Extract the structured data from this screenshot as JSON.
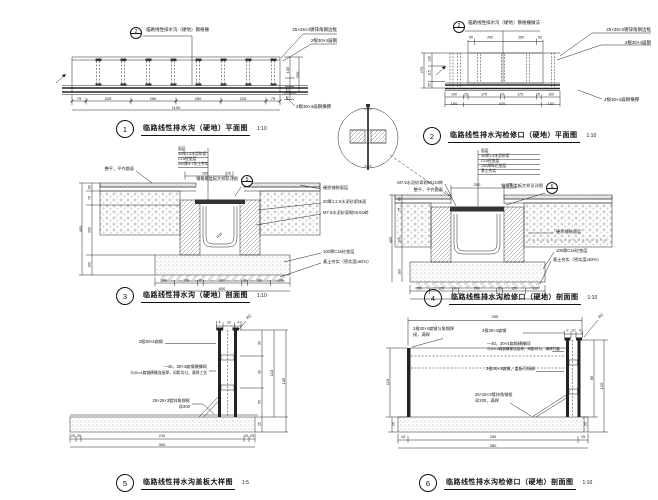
{
  "page": {
    "width": 658,
    "height": 500,
    "background": "#ffffff",
    "line_color": "#222222",
    "text_color": "#151515"
  },
  "details": [
    {
      "id": "detail-1",
      "number": "1",
      "title": "临路线性排水沟（硬地）平面图",
      "scale": "1:10",
      "labels": [
        {
          "x": 146,
          "y": 30,
          "a": "l",
          "s": 4.5,
          "tx": "临路线性排水沟（硬地）钢格栅",
          "n": "annotation"
        },
        {
          "bubble": true,
          "x": 136,
          "y": 33,
          "r": 6,
          "split": true,
          "num": "2"
        },
        {
          "x": 337,
          "y": 30,
          "a": "r",
          "s": 4.5,
          "tx": "25×25×3镀锌角钢边框",
          "n": "annotation"
        },
        {
          "x": 337,
          "y": 41,
          "a": "r",
          "s": 4.5,
          "tx": "2根30×4扁钢",
          "n": "annotation"
        },
        {
          "x": 288,
          "y": 70,
          "s": 4,
          "rot": -90,
          "tx": "105"
        },
        {
          "x": 297.5,
          "y": 75,
          "s": 4,
          "rot": -90,
          "tx": "250"
        },
        {
          "x": 288,
          "y": 90,
          "s": 3.5,
          "rot": -90,
          "tx": "25"
        },
        {
          "x": 288,
          "y": 98,
          "s": 3.5,
          "rot": -90,
          "tx": "75"
        },
        {
          "x": 79,
          "y": 99,
          "s": 4,
          "tx": "75"
        },
        {
          "x": 108,
          "y": 99,
          "s": 4,
          "tx": "225"
        },
        {
          "x": 153,
          "y": 99,
          "s": 4,
          "tx": "250"
        },
        {
          "x": 198,
          "y": 99,
          "s": 4,
          "tx": "250"
        },
        {
          "x": 243,
          "y": 99,
          "s": 4,
          "tx": "225"
        },
        {
          "x": 273,
          "y": 99,
          "s": 4,
          "tx": "75"
        },
        {
          "x": 176,
          "y": 108,
          "s": 4,
          "tx": "1100"
        },
        {
          "x": 296,
          "y": 107,
          "a": "l",
          "s": 4.5,
          "tx": "4根30×4扁钢横撑",
          "n": "annotation"
        }
      ]
    },
    {
      "id": "detail-2",
      "number": "2",
      "title": "临路线性排水沟检修口（硬地）平面图",
      "scale": "1:10",
      "labels": [
        {
          "bubble": true,
          "x": 459,
          "y": 27,
          "r": 6,
          "split": true,
          "num": "2"
        },
        {
          "x": 468,
          "y": 23,
          "a": "l",
          "s": 4.5,
          "tx": "临路线性排水沟（硬地）钢格栅做法",
          "n": "annotation"
        },
        {
          "x": 651,
          "y": 30,
          "a": "r",
          "s": 4.5,
          "tx": "25×25×3镀锌角钢边框",
          "n": "annotation"
        },
        {
          "x": 651,
          "y": 43,
          "a": "r",
          "s": 4.5,
          "tx": "2根30×4扁钢",
          "n": "annotation"
        },
        {
          "x": 471,
          "y": 38,
          "s": 3.5,
          "tx": "50"
        },
        {
          "x": 490,
          "y": 38,
          "s": 3.5,
          "tx": "250"
        },
        {
          "x": 521,
          "y": 38,
          "s": 3.5,
          "tx": "250"
        },
        {
          "x": 540,
          "y": 38,
          "s": 3.5,
          "tx": "50"
        },
        {
          "x": 430,
          "y": 59,
          "s": 3.5,
          "rot": -90,
          "tx": "130"
        },
        {
          "x": 430,
          "y": 73,
          "s": 3.5,
          "rot": -90,
          "tx": "115"
        },
        {
          "x": 430,
          "y": 85,
          "s": 3.5,
          "rot": -90,
          "tx": "25"
        },
        {
          "x": 422,
          "y": 70,
          "s": 4,
          "rot": -90,
          "tx": "270"
        },
        {
          "x": 454,
          "y": 95,
          "s": 3.5,
          "tx": "100"
        },
        {
          "x": 466,
          "y": 95,
          "s": 3.5,
          "tx": "25"
        },
        {
          "x": 484,
          "y": 95,
          "s": 3.5,
          "tx": "175"
        },
        {
          "x": 502,
          "y": 95,
          "s": 3.5,
          "tx": "20"
        },
        {
          "x": 520,
          "y": 95,
          "s": 3.5,
          "tx": "175"
        },
        {
          "x": 538,
          "y": 95,
          "s": 3.5,
          "tx": "25"
        },
        {
          "x": 551,
          "y": 95,
          "s": 3.5,
          "tx": "100"
        },
        {
          "x": 454,
          "y": 103.5,
          "s": 4,
          "tx": "100"
        },
        {
          "x": 502,
          "y": 103.5,
          "s": 4,
          "tx": "420"
        },
        {
          "x": 551,
          "y": 103.5,
          "s": 4,
          "tx": "100"
        },
        {
          "x": 604,
          "y": 100,
          "a": "l",
          "s": 4.5,
          "tx": "4根30×4扁钢横撑",
          "n": "annotation"
        }
      ]
    },
    {
      "id": "detail-3",
      "number": "3",
      "title": "临路线性排水沟（硬地）剖面图",
      "scale": "1:10",
      "labels": [
        {
          "x": 178,
          "y": 150,
          "a": "l",
          "s": 3.8,
          "tx": "面层",
          "n": "annotation"
        },
        {
          "x": 178,
          "y": 155,
          "a": "l",
          "s": 3.8,
          "tx": "30厚1:3水泥砂浆",
          "n": "annotation"
        },
        {
          "x": 178,
          "y": 160,
          "a": "l",
          "s": 3.8,
          "tx": "C15砼垫层",
          "n": "annotation"
        },
        {
          "x": 178,
          "y": 165,
          "a": "l",
          "s": 3.8,
          "tx": "300厚3:7灰土夯实",
          "n": "annotation"
        },
        {
          "x": 205,
          "y": 174,
          "s": 3.5,
          "tx": "265"
        },
        {
          "x": 229,
          "y": 174,
          "s": 3.5,
          "tx": "25"
        },
        {
          "x": 134,
          "y": 169,
          "a": "r",
          "s": 4.2,
          "tx": "整平，平齐路面",
          "n": "annotation"
        },
        {
          "x": 238,
          "y": 179,
          "a": "r",
          "s": 4.2,
          "tx": "钢格栅盖板大样见详图",
          "n": "callout-text"
        },
        {
          "bubble": true,
          "x": 247,
          "y": 181,
          "r": 6,
          "split": true,
          "num": "5"
        },
        {
          "x": 323,
          "y": 188,
          "a": "l",
          "s": 4.2,
          "tx": "硬质铺装面层",
          "n": "annotation"
        },
        {
          "x": 323,
          "y": 202,
          "a": "l",
          "s": 4.2,
          "tx": "20厚1:2.5水泥砂浆抹面",
          "n": "annotation"
        },
        {
          "x": 323,
          "y": 213,
          "a": "l",
          "s": 4.2,
          "tx": "M7.5水泥砂浆砌MU10砖",
          "n": "annotation"
        },
        {
          "x": 323,
          "y": 252,
          "a": "l",
          "s": 4.2,
          "tx": "100厚C15砼垫层",
          "n": "annotation"
        },
        {
          "x": 323,
          "y": 262,
          "a": "l",
          "s": 4.2,
          "tx": "素土夯实（密实度≥92%）",
          "n": "annotation"
        },
        {
          "x": 220,
          "y": 236,
          "s": 3.5,
          "rot": -45,
          "tx": "R30"
        },
        {
          "x": 90,
          "y": 187,
          "s": 3.5,
          "rot": -90,
          "tx": "80"
        },
        {
          "x": 90,
          "y": 198,
          "s": 3.5,
          "rot": -90,
          "tx": "75"
        },
        {
          "x": 90,
          "y": 230,
          "s": 3.5,
          "rot": -90,
          "tx": "200"
        },
        {
          "x": 90,
          "y": 265,
          "s": 3.5,
          "rot": -90,
          "tx": "100"
        },
        {
          "x": 81,
          "y": 229,
          "s": 4,
          "rot": -90,
          "tx": "455"
        },
        {
          "x": 164,
          "y": 281,
          "s": 3.5,
          "tx": "100"
        },
        {
          "x": 186,
          "y": 281,
          "s": 3.5,
          "tx": "120"
        },
        {
          "x": 200,
          "y": 281,
          "s": 3.5,
          "tx": "30"
        },
        {
          "x": 222,
          "y": 281,
          "s": 3.5,
          "tx": "200"
        },
        {
          "x": 245,
          "y": 281,
          "s": 3.5,
          "tx": "30"
        },
        {
          "x": 259,
          "y": 281,
          "s": 3.5,
          "tx": "120"
        },
        {
          "x": 280,
          "y": 281,
          "s": 3.5,
          "tx": "100"
        },
        {
          "x": 222,
          "y": 289,
          "s": 4,
          "tx": "600"
        }
      ]
    },
    {
      "id": "detail-4",
      "number": "4",
      "title": "临路线性排水沟检修口（硬地）剖面图",
      "scale": "1:10",
      "labels": [
        {
          "x": 481,
          "y": 152,
          "a": "l",
          "s": 3.8,
          "tx": "面层",
          "n": "annotation"
        },
        {
          "x": 481,
          "y": 157,
          "a": "l",
          "s": 3.8,
          "tx": "30厚1:3水泥砂浆",
          "n": "annotation"
        },
        {
          "x": 481,
          "y": 162,
          "a": "l",
          "s": 3.8,
          "tx": "C15砼垫层",
          "n": "annotation"
        },
        {
          "x": 481,
          "y": 167,
          "a": "l",
          "s": 3.8,
          "tx": "150厚碎石垫层",
          "n": "annotation"
        },
        {
          "x": 481,
          "y": 172,
          "a": "l",
          "s": 3.8,
          "tx": "素土夯实",
          "n": "annotation"
        },
        {
          "x": 477,
          "y": 185,
          "s": 4,
          "tx": "250"
        },
        {
          "x": 510,
          "y": 185,
          "s": 3.5,
          "tx": "25"
        },
        {
          "x": 443,
          "y": 183,
          "a": "r",
          "s": 4.2,
          "tx": "M7.5水泥砂浆砌MU10砖",
          "n": "annotation"
        },
        {
          "x": 443,
          "y": 190,
          "a": "r",
          "s": 4.2,
          "tx": "整平，平齐路面",
          "n": "annotation"
        },
        {
          "x": 543,
          "y": 186,
          "a": "r",
          "s": 4.2,
          "tx": "钢格栅盖板大样见详图",
          "n": "callout-text"
        },
        {
          "bubble": true,
          "x": 552,
          "y": 188,
          "r": 6,
          "split": true,
          "num": "6"
        },
        {
          "x": 556,
          "y": 232,
          "a": "l",
          "s": 4.2,
          "tx": "硬质铺装面层",
          "n": "annotation"
        },
        {
          "x": 556,
          "y": 251,
          "a": "l",
          "s": 4.2,
          "tx": "100厚C15砼垫层",
          "n": "annotation"
        },
        {
          "x": 553,
          "y": 260,
          "a": "l",
          "s": 4.2,
          "tx": "素土夯实（密实度≥92%）",
          "n": "annotation"
        },
        {
          "x": 400,
          "y": 199,
          "s": 3.5,
          "rot": -90,
          "tx": "80"
        },
        {
          "x": 400,
          "y": 210,
          "s": 3.5,
          "rot": -90,
          "tx": "75"
        },
        {
          "x": 400,
          "y": 240,
          "s": 3.5,
          "rot": -90,
          "tx": "200"
        },
        {
          "x": 400,
          "y": 272,
          "s": 3.5,
          "rot": -90,
          "tx": "100"
        },
        {
          "x": 391,
          "y": 240,
          "s": 4,
          "rot": -90,
          "tx": "455"
        },
        {
          "x": 419,
          "y": 289,
          "s": 3.5,
          "tx": "100"
        },
        {
          "x": 441,
          "y": 289,
          "s": 3.5,
          "tx": "120"
        },
        {
          "x": 455,
          "y": 289,
          "s": 3.5,
          "tx": "30"
        },
        {
          "x": 477,
          "y": 289,
          "s": 3.5,
          "tx": "200"
        },
        {
          "x": 500,
          "y": 289,
          "s": 3.5,
          "tx": "30"
        },
        {
          "x": 514,
          "y": 289,
          "s": 3.5,
          "tx": "120"
        },
        {
          "x": 535,
          "y": 289,
          "s": 3.5,
          "tx": "100"
        },
        {
          "x": 477,
          "y": 297,
          "s": 4,
          "tx": "600"
        }
      ]
    },
    {
      "id": "detail-5",
      "number": "5",
      "title": "临路线性排水沟盖板大样图",
      "scale": "1:5",
      "labels": [
        {
          "x": 163,
          "y": 342,
          "a": "r",
          "s": 4.2,
          "tx": "2根30×4扁钢",
          "n": "annotation"
        },
        {
          "x": 207,
          "y": 367,
          "a": "r",
          "s": 4.2,
          "tx": "—40，30×4扁钢横撑网",
          "n": "annotation"
        },
        {
          "x": 207,
          "y": 374,
          "a": "r",
          "s": 3.8,
          "tx": "与30×4扁钢横撑连接焊，间距均匀，满焊工艺",
          "n": "annotation"
        },
        {
          "x": 190,
          "y": 401,
          "a": "r",
          "s": 4.2,
          "tx": "25×25×3镀锌角钢框",
          "n": "annotation"
        },
        {
          "x": 190,
          "y": 407,
          "a": "r",
          "s": 4.2,
          "tx": "@200",
          "n": "annotation"
        },
        {
          "x": 219.5,
          "y": 323,
          "s": 3.5,
          "tx": "4"
        },
        {
          "x": 229,
          "y": 323,
          "s": 3.5,
          "tx": "20"
        },
        {
          "x": 238.5,
          "y": 323,
          "s": 3.5,
          "tx": "4"
        },
        {
          "x": 249,
          "y": 317,
          "s": 4,
          "rot": -45,
          "tx": "R2"
        },
        {
          "x": 260,
          "y": 343,
          "s": 3.5,
          "rot": -90,
          "tx": "30"
        },
        {
          "x": 260,
          "y": 372,
          "s": 3.5,
          "rot": -90,
          "tx": "30"
        },
        {
          "x": 260,
          "y": 402,
          "s": 3.5,
          "rot": -90,
          "tx": "50"
        },
        {
          "x": 260,
          "y": 424,
          "s": 3.5,
          "rot": -90,
          "tx": "25"
        },
        {
          "x": 272,
          "y": 373,
          "s": 4,
          "rot": -90,
          "tx": "110"
        },
        {
          "x": 284,
          "y": 381,
          "s": 4,
          "rot": -90,
          "tx": "135"
        },
        {
          "x": 73,
          "y": 437,
          "s": 3.8,
          "tx": "25"
        },
        {
          "x": 79,
          "y": 437,
          "s": 3.8,
          "tx": "20"
        },
        {
          "x": 162,
          "y": 437,
          "s": 3.8,
          "tx": "210"
        },
        {
          "x": 246,
          "y": 437,
          "s": 3.8,
          "tx": "20"
        },
        {
          "x": 252,
          "y": 437,
          "s": 3.8,
          "tx": "25"
        },
        {
          "x": 162,
          "y": 445,
          "s": 4,
          "tx": "300"
        }
      ]
    },
    {
      "id": "detail-6",
      "number": "6",
      "title": "临路线性排水沟检修口（硬地）剖面图",
      "scale": "1:10",
      "labels": [
        {
          "x": 495,
          "y": 317,
          "s": 4,
          "tx": "255"
        },
        {
          "x": 567.5,
          "y": 331,
          "s": 3.5,
          "tx": "2"
        },
        {
          "x": 573.5,
          "y": 331,
          "s": 3.5,
          "tx": "20"
        },
        {
          "x": 580,
          "y": 331,
          "s": 3.5,
          "tx": "4"
        },
        {
          "x": 601,
          "y": 316,
          "s": 4,
          "rot": -45,
          "tx": "R2"
        },
        {
          "x": 413,
          "y": 329,
          "a": "l",
          "s": 4.2,
          "tx": "2根30×4扁钢与角钢焊",
          "n": "annotation"
        },
        {
          "x": 413,
          "y": 335,
          "a": "l",
          "s": 4.2,
          "tx": "接，满焊",
          "n": "annotation"
        },
        {
          "x": 482,
          "y": 331,
          "a": "l",
          "s": 4.2,
          "tx": "2根30×4扁钢",
          "n": "annotation"
        },
        {
          "x": 487,
          "y": 344,
          "a": "l",
          "s": 4.2,
          "tx": "—40，30×4扁钢横撑网",
          "n": "annotation"
        },
        {
          "x": 487,
          "y": 350,
          "a": "l",
          "s": 3.6,
          "tx": "与30×4扁钢横撑连接焊，间距均匀，满焊打磨",
          "n": "annotation"
        },
        {
          "x": 486,
          "y": 369,
          "a": "l",
          "s": 4.2,
          "tx": "2根30×4扁钢，盖板可拆卸",
          "n": "annotation"
        },
        {
          "x": 475,
          "y": 395,
          "a": "l",
          "s": 4.2,
          "tx": "25×25×3镀锌角钢框",
          "n": "annotation"
        },
        {
          "x": 475,
          "y": 401,
          "a": "l",
          "s": 4.2,
          "tx": "@200，满焊",
          "n": "annotation"
        },
        {
          "x": 388,
          "y": 382,
          "s": 4,
          "rot": -90,
          "tx": "110"
        },
        {
          "x": 394,
          "y": 424,
          "s": 3.5,
          "rot": -90,
          "tx": "25"
        },
        {
          "x": 592,
          "y": 378,
          "s": 4,
          "rot": -90,
          "tx": "85"
        },
        {
          "x": 602,
          "y": 386,
          "s": 4,
          "rot": -90,
          "tx": "120"
        },
        {
          "x": 586,
          "y": 424,
          "s": 3.5,
          "rot": -90,
          "tx": "25"
        },
        {
          "x": 403,
          "y": 438,
          "s": 3.8,
          "tx": "15"
        },
        {
          "x": 493,
          "y": 438,
          "s": 3.8,
          "tx": "250"
        },
        {
          "x": 583,
          "y": 438,
          "s": 3.8,
          "tx": "15"
        },
        {
          "x": 493,
          "y": 446,
          "s": 4,
          "tx": "280"
        }
      ]
    }
  ]
}
